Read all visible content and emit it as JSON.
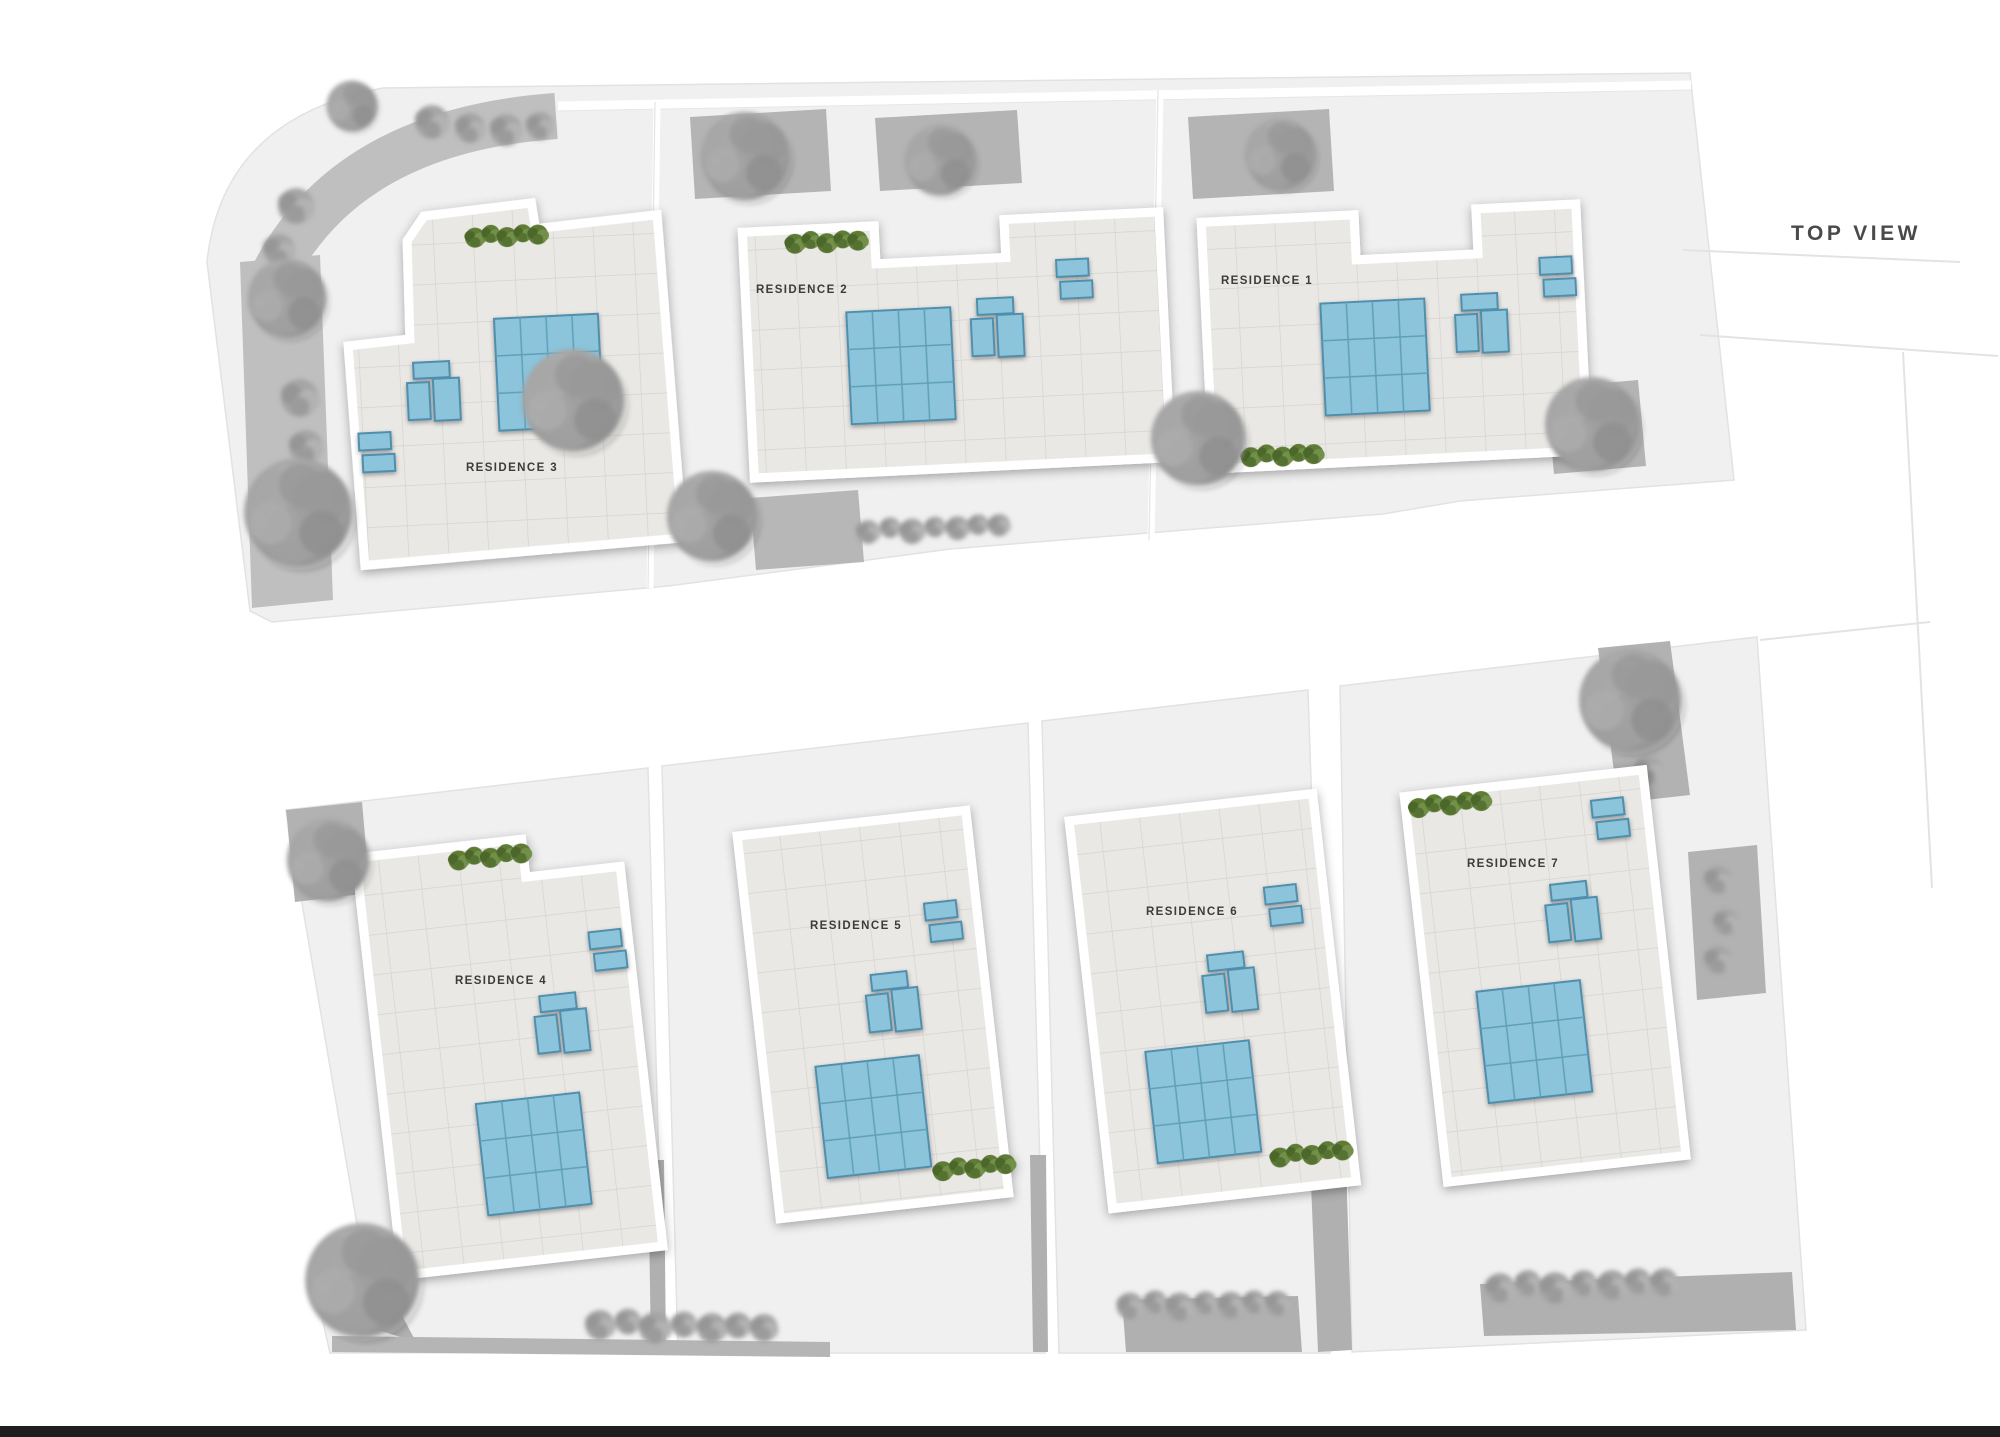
{
  "page": {
    "title": "TOP VIEW",
    "type_label": "site plan top view"
  },
  "residences": [
    {
      "id": 1,
      "label": "RESIDENCE 1",
      "solar_array": "4x3 panels",
      "ac_units": 3,
      "small_rooftop_panels": 2,
      "hedge_position": "bottom-left"
    },
    {
      "id": 2,
      "label": "RESIDENCE 2",
      "solar_array": "4x3 panels",
      "ac_units": 3,
      "small_rooftop_panels": 2,
      "hedge_position": "top-left"
    },
    {
      "id": 3,
      "label": "RESIDENCE 3",
      "solar_array": "4x3 panels",
      "ac_units": 3,
      "small_rooftop_panels": 2,
      "hedge_position": "top"
    },
    {
      "id": 4,
      "label": "RESIDENCE 4",
      "solar_array": "4x3 panels",
      "ac_units": 3,
      "small_rooftop_panels": 2,
      "hedge_position": "top-left"
    },
    {
      "id": 5,
      "label": "RESIDENCE 5",
      "solar_array": "4x3 panels",
      "ac_units": 3,
      "small_rooftop_panels": 2,
      "hedge_position": "bottom-right"
    },
    {
      "id": 6,
      "label": "RESIDENCE 6",
      "solar_array": "4x3 panels",
      "ac_units": 3,
      "small_rooftop_panels": 2,
      "hedge_position": "bottom-right"
    },
    {
      "id": 7,
      "label": "RESIDENCE 7",
      "solar_array": "4x3 panels",
      "ac_units": 3,
      "small_rooftop_panels": 2,
      "hedge_position": "top-left"
    }
  ],
  "colors": {
    "background": "#ffffff",
    "parcel": "#f0f0f1",
    "roof_tile": "#e9e8e5",
    "roof_tile_line": "#d5d3cf",
    "parapet": "#ffffff",
    "solar_panel": "#8bc4db",
    "solar_panel_border": "#4f8fad",
    "planter": "#b4b4b4",
    "road_band": "#bfbfbf",
    "tree_gray": "#9a9a9a",
    "hedge_green": "#5e7c36",
    "label_text": "#3c3c3c",
    "title_text": "#4a4a4a",
    "footer_bar": "#1e1e1e"
  }
}
